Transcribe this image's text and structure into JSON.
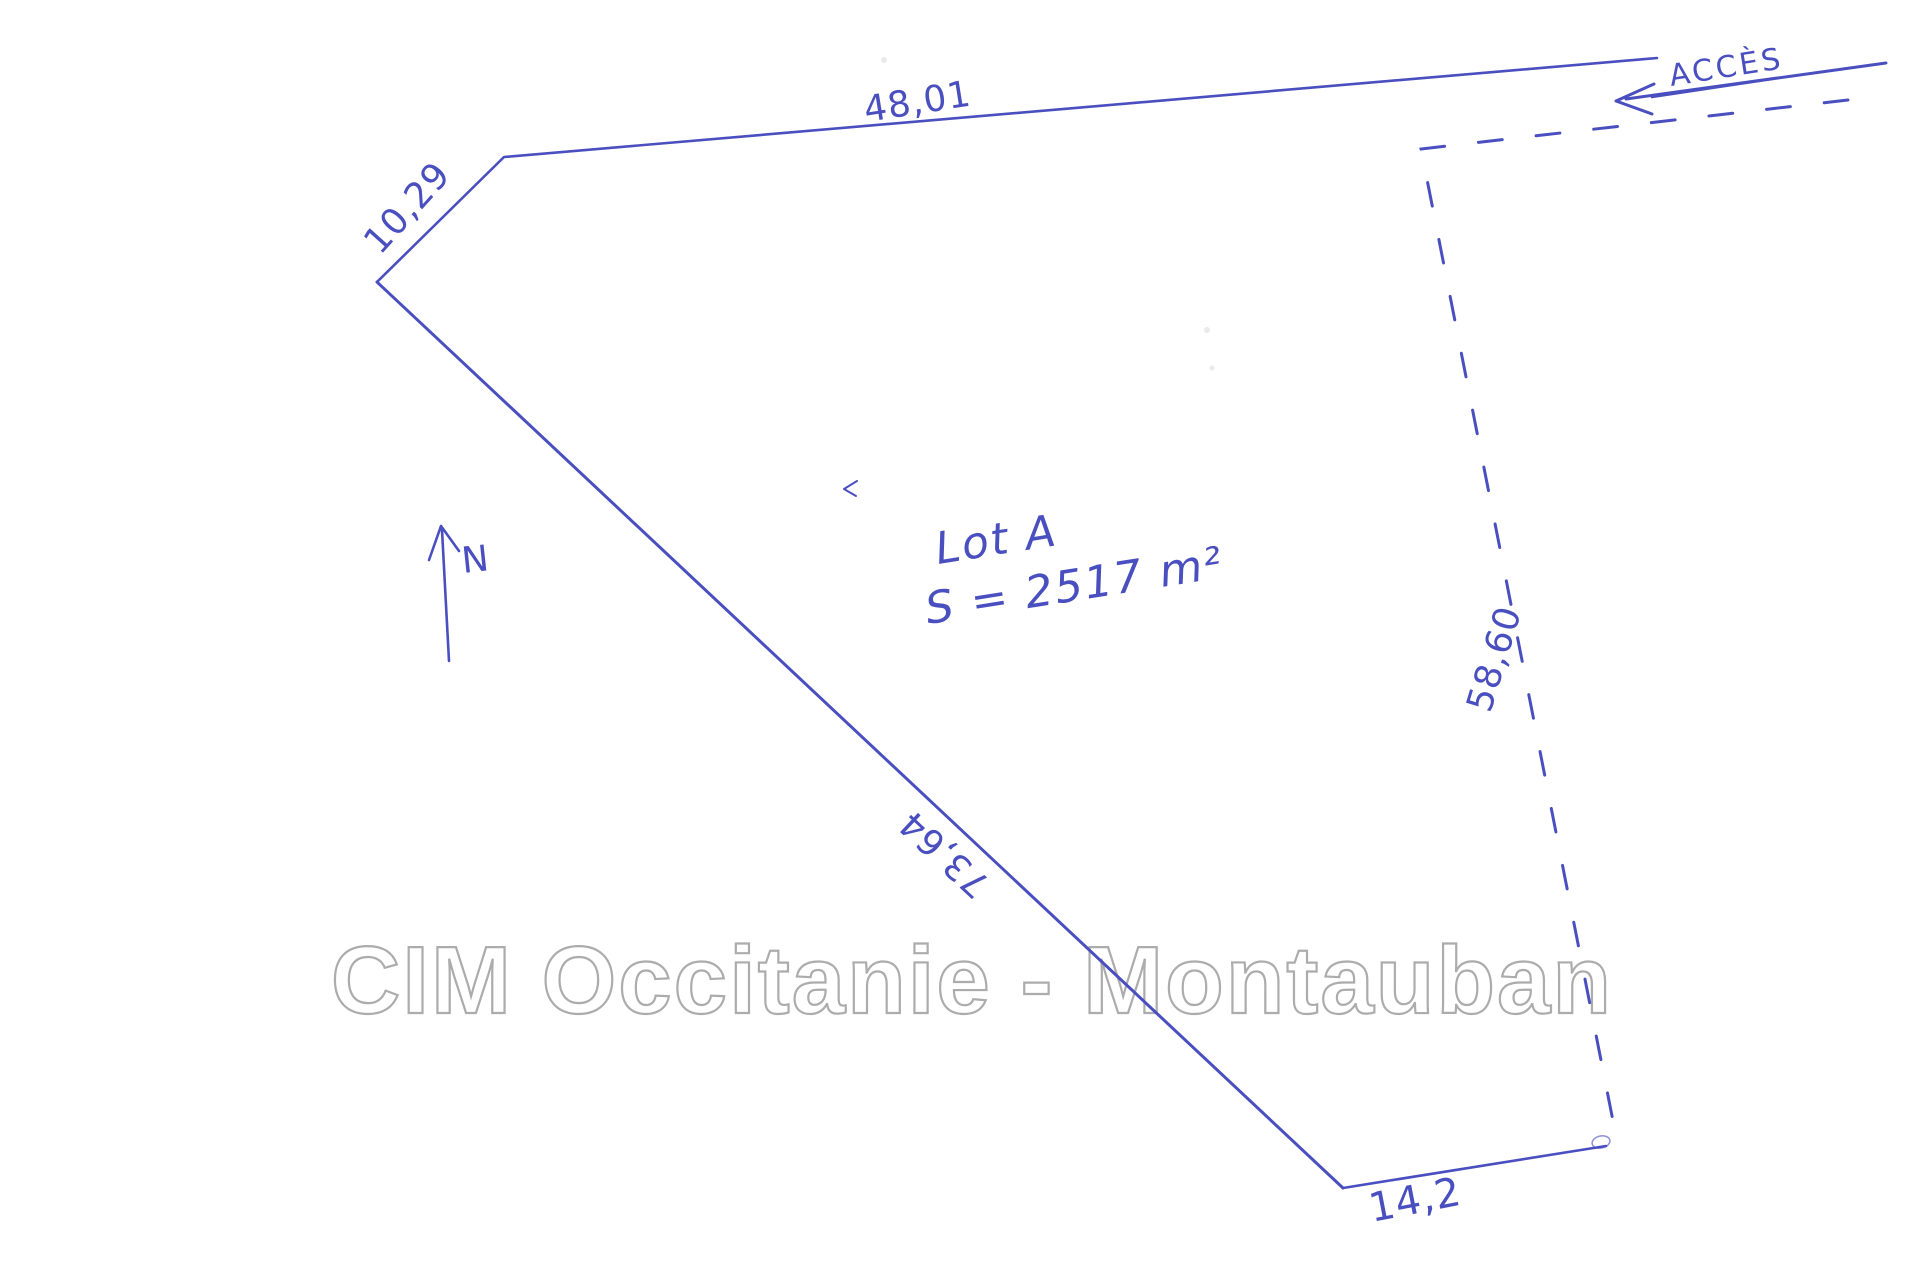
{
  "colors": {
    "ink": "#4a4fc0",
    "watermark_outline": "#9e9e9e",
    "paper": "#ffffff"
  },
  "watermark": {
    "text": "CIM Occitanie - Montauban"
  },
  "parcel": {
    "name": "Lot A",
    "area": "S = 2517 m²"
  },
  "compass": {
    "north_label": "N"
  },
  "access": {
    "label": "ACCÈS"
  },
  "dimensions": {
    "top_edge": "48,01",
    "northwest_edge": "10,29",
    "southwest_edge": "73,64",
    "bottom_edge": "14,2",
    "east_edge": "58,60"
  }
}
